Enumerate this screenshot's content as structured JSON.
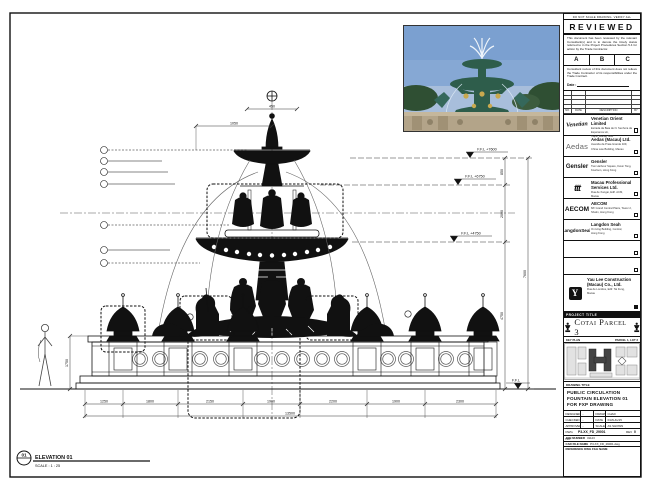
{
  "sheet_note": "DO NOT SCALE DRAWING. VERIFY ALL DIMENSIONS ON SITE.",
  "stamp": {
    "title": "REVIEWED",
    "para1": "This document has been reviewed by the relevant Consultant(s) and is to denote the timely status referred to in the Project Procedures Section 5.4 for action by the Trade Contractor.",
    "options": {
      "a": "A",
      "b": "B",
      "c": "C"
    },
    "para2": "Consultant review of this document does not relieve the Trade Contractor of its responsibilities under the Trade Contract.",
    "date_label": "Date :",
    "rev_headers": {
      "no": "NO.",
      "date": "DATE",
      "desc": "DESCRIPTION",
      "by": "BY"
    }
  },
  "consultants": [
    {
      "logo": "Venetian",
      "name": "Venetian Orient Limited",
      "addr1": "Estrada da Baia de N. Senhora da Esperanca s/n,",
      "addr2": "Taipa, Macau SAR"
    },
    {
      "logo": "Aedas",
      "name": "Aedas (Macau) Ltd.",
      "addr1": "Avenida da Praia Grande 409,",
      "addr2": "China Law Building, Macau"
    },
    {
      "logo": "Gensler",
      "name": "Gensler",
      "addr1": "Two Harbour Square, Kwun Tong,",
      "addr2": "Kowloon, Hong Kong"
    },
    {
      "logo": "ttt",
      "name": "Macau Professional Services Ltd.",
      "addr1": "Rua de Xangai, Edif. ACM,",
      "addr2": "Macau"
    },
    {
      "logo": "AECOM",
      "name": "AECOM",
      "addr1": "8/F Grand Central Plaza, Tower 2,",
      "addr2": "Shatin, Hong Kong"
    },
    {
      "logo": "LangdonSeah",
      "name": "Langdon Seah",
      "addr1": "On Hing Building, Central,",
      "addr2": "Hong Kong"
    }
  ],
  "contractor": {
    "name1": "Yau Lee Construction",
    "name2": "(Macau) Co., Ltd.",
    "addr1": "Rua de Londres, Edif. Tai Fung,",
    "addr2": "Macau"
  },
  "titleblock": {
    "project_label": "PROJECT TITLE",
    "project_title": "Cotai Parcel 3",
    "keyplan_label": "KEY PLAN",
    "keyplan_right": "PARCEL 1, LOT 3",
    "drawing_title_label": "DRAWING TITLE",
    "title_line1": "PUBLIC CIRCULATION",
    "title_line2": "FOUNTAIN ELEVATION 01",
    "title_line3": "FOR FXP DRAWING",
    "rows": {
      "designed": "DESIGNED",
      "v_designed": "-",
      "drawn": "DRAWN",
      "v_drawn": "CHAD",
      "checked": "CHECKED",
      "v_checked": "-",
      "date": "DATE",
      "v_date": "03/AUG/15",
      "approved": "APPROVED",
      "v_approved": "-",
      "scale": "SCALE",
      "v_scale": "AS SHOWN"
    },
    "dwg_label": "DWG NO.",
    "dwg_no": "P3-XX_FD_29001",
    "rev_label": "REV",
    "rev": "0",
    "job_label": "JOB NUMBER",
    "job_no": "31123",
    "cad_label": "CAD FILE NAME",
    "cad_file": "P3-XX_FD_29001.dwg",
    "ref_label": "REFERENCE DWG FILE NAME"
  },
  "drawing": {
    "levels": {
      "l1": "F.F.L +7600",
      "l2": "F.F.L +6750",
      "l3": "F.F.L +4750",
      "l4": "F.F.L"
    },
    "vdims": {
      "d1": "850",
      "d2": "2000",
      "d3": "4750",
      "total": "7600",
      "wall": "1750"
    },
    "topdims": {
      "d1": "450",
      "d2": "1050"
    },
    "botdims": [
      "1250",
      "1800",
      "2150",
      "1900",
      "2200",
      "1900",
      "2300"
    ],
    "total": "13500",
    "tag": {
      "num": "01",
      "label": "ELEVATION 01",
      "scale": "SCALE : 1 : 25"
    }
  }
}
